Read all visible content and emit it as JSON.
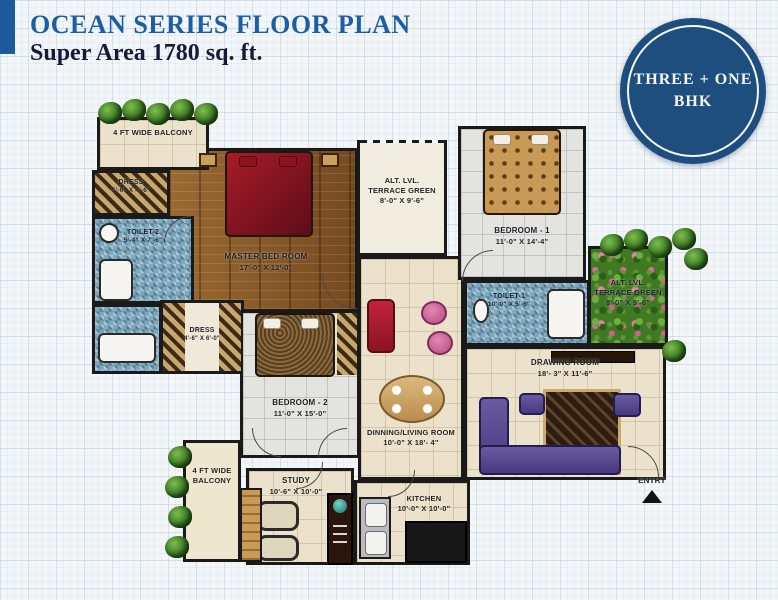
{
  "header": {
    "title": "OCEAN SERIES FLOOR PLAN",
    "subtitle": "Super Area 1780 sq. ft."
  },
  "badge": {
    "line1": "THREE + ONE",
    "line2": "BHK"
  },
  "colors": {
    "accent": "#1d5a9b",
    "title_blue": "#1b5ea5",
    "subtitle_navy": "#131c36",
    "badge_bg": "#1d4e7e",
    "wall": "#1a1a1a"
  },
  "rooms": {
    "balcony_top": {
      "name": "4 FT WIDE BALCONY"
    },
    "dress1": {
      "name": "DRESS",
      "dims": "5'-6\" X 4'-6\""
    },
    "toilet2": {
      "name": "TOILET-2",
      "dims": "5'-4\" X 7'-6\""
    },
    "master_bedroom": {
      "name": "MASTER BED ROOM",
      "dims": "17'-0\" X 12'-0\""
    },
    "terrace_top": {
      "line1": "ALT. LVL.",
      "line2": "TERRACE GREEN",
      "dims": "8'-0\" X 9'-6\""
    },
    "bedroom1": {
      "name": "BEDROOM - 1",
      "dims": "11'-0\" X 14'-4\""
    },
    "toilet1": {
      "name": "TOILET-1",
      "dims": "10'-0\" X 5'-6\""
    },
    "terrace_right": {
      "line1": "ALT. LVL.",
      "line2": "TERRACE GREEN",
      "dims": "8'-0\" X 9'-6\""
    },
    "drawing_room": {
      "name": "DRAWING ROOM",
      "dims": "18'- 3\" X 11'-6\""
    },
    "dress2": {
      "name": "DRESS",
      "dims": "4'-6\" X 6'-0\""
    },
    "bedroom2": {
      "name": "BEDROOM - 2",
      "dims": "11'-0\" X 15'-0\""
    },
    "dining": {
      "name": "DINNING/LIVING ROOM",
      "dims": "10'-0\" X 18'- 4\""
    },
    "study": {
      "name": "STUDY",
      "dims": "10'-6\" X 10'-0\""
    },
    "kitchen": {
      "name": "KITCHEN",
      "dims": "10'-0\" X 10'-0\""
    },
    "balcony_bottom": {
      "name": "4 FT WIDE BALCONY"
    },
    "entry": {
      "label": "ENTRY"
    }
  }
}
